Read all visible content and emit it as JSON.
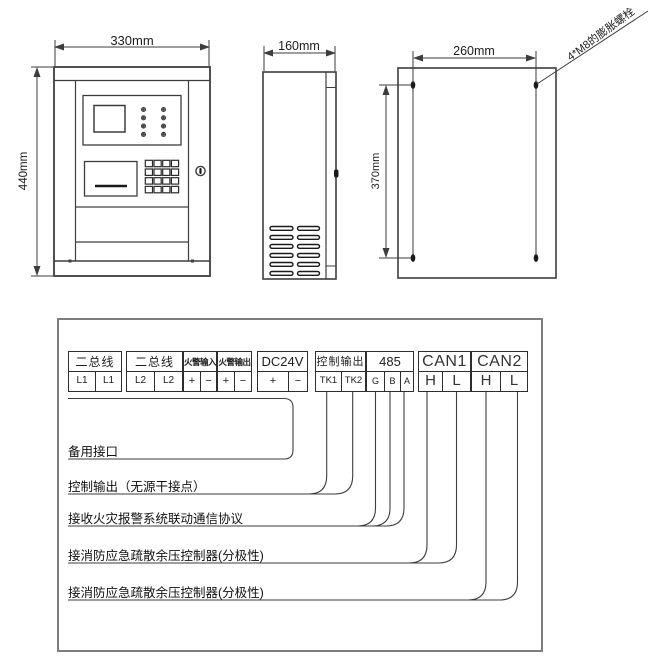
{
  "dimensions": {
    "front_width": "330mm",
    "front_height": "440mm",
    "side_depth": "160mm",
    "mount_width": "260mm",
    "mount_height": "370mm",
    "bolt_note": "4*M8的膨胀螺栓"
  },
  "terminal_table": {
    "groups": [
      {
        "label": "二总线",
        "cells": [
          "L1",
          "L1"
        ]
      },
      {
        "label": "二总线",
        "cells": [
          "L2",
          "L2"
        ]
      },
      {
        "label": "火警输入",
        "cells": [
          "+",
          "−"
        ]
      },
      {
        "label": "火警输出",
        "cells": [
          "+",
          "−"
        ]
      },
      {
        "label": "DC24V",
        "cells": [
          "+",
          "−"
        ]
      },
      {
        "label": "控制输出",
        "cells": [
          "TK1",
          "TK2"
        ]
      },
      {
        "label": "485",
        "cells": [
          "G",
          "B",
          "A"
        ]
      },
      {
        "label": "CAN1",
        "cells": [
          "H",
          "L"
        ]
      },
      {
        "label": "CAN2",
        "cells": [
          "H",
          "L"
        ]
      }
    ]
  },
  "callouts": [
    {
      "text": "备用接口"
    },
    {
      "text": "控制输出（无源干接点）"
    },
    {
      "text": "接收火灾报警系统联动通信协议"
    },
    {
      "text": "接消防应急疏散余压控制器(分极性)"
    },
    {
      "text": "接消防应急疏散余压控制器(分极性)"
    }
  ],
  "colors": {
    "line": "#3d3d3d",
    "text": "#1c1c1c",
    "box_border": "#7e7e7e"
  }
}
